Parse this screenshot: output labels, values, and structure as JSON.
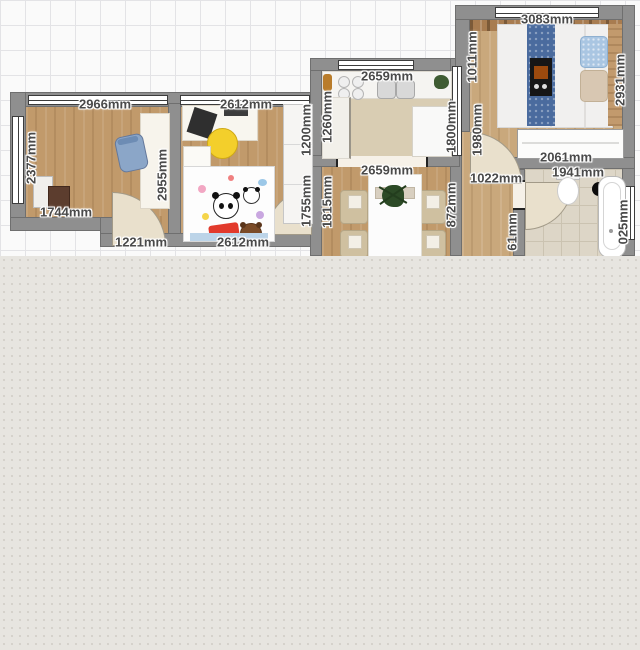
{
  "plan": {
    "unit": "mm",
    "labels": [
      {
        "text": "2966mm",
        "orientation": "horizontal",
        "room": "office",
        "edge": "top"
      },
      {
        "text": "2612mm",
        "orientation": "horizontal",
        "room": "kids-room",
        "edge": "top"
      },
      {
        "text": "2659mm",
        "orientation": "horizontal",
        "room": "kitchen",
        "edge": "top"
      },
      {
        "text": "3083mm",
        "orientation": "horizontal",
        "room": "bedroom",
        "edge": "top"
      },
      {
        "text": "2659mm",
        "orientation": "horizontal",
        "room": "dining-room",
        "edge": "top"
      },
      {
        "text": "1744mm",
        "orientation": "horizontal",
        "room": "office",
        "edge": "bottom"
      },
      {
        "text": "1221mm",
        "orientation": "horizontal",
        "room": "hallway",
        "edge": "bottom"
      },
      {
        "text": "2612mm",
        "orientation": "horizontal",
        "room": "kids-room",
        "edge": "bottom"
      },
      {
        "text": "1022mm",
        "orientation": "horizontal",
        "room": "hallway",
        "edge": "bathroom-door"
      },
      {
        "text": "2061mm",
        "orientation": "horizontal",
        "room": "bedroom",
        "edge": "wardrobe"
      },
      {
        "text": "1941mm",
        "orientation": "horizontal",
        "room": "bathroom",
        "edge": "top"
      },
      {
        "text": "2377mm",
        "orientation": "vertical",
        "room": "office",
        "edge": "left"
      },
      {
        "text": "2955mm",
        "orientation": "vertical",
        "room": "office",
        "edge": "right"
      },
      {
        "text": "1200mm",
        "orientation": "vertical",
        "room": "kids-room",
        "edge": "right-upper"
      },
      {
        "text": "1755mm",
        "orientation": "vertical",
        "room": "kids-room",
        "edge": "right-lower"
      },
      {
        "text": "1260mm",
        "orientation": "vertical",
        "room": "kitchen",
        "edge": "left"
      },
      {
        "text": "1815mm",
        "orientation": "vertical",
        "room": "dining-room",
        "edge": "left"
      },
      {
        "text": "1800mm",
        "orientation": "vertical",
        "room": "kitchen",
        "edge": "right"
      },
      {
        "text": "872mm",
        "orientation": "vertical",
        "room": "dining-room",
        "edge": "right"
      },
      {
        "text": "1011mm",
        "orientation": "vertical",
        "room": "bedroom",
        "edge": "left-upper"
      },
      {
        "text": "1980mm",
        "orientation": "vertical",
        "room": "bedroom",
        "edge": "left-lower"
      },
      {
        "text": "2931mm",
        "orientation": "vertical",
        "room": "bedroom",
        "edge": "right"
      },
      {
        "text": "61mm",
        "orientation": "vertical",
        "room": "bathroom",
        "edge": "left-truncated"
      },
      {
        "text": "025mm",
        "orientation": "vertical",
        "room": "bathroom",
        "edge": "right-truncated"
      }
    ],
    "rooms": [
      "office",
      "kids-room",
      "kitchen",
      "dining-room",
      "bedroom",
      "bathroom",
      "hallway"
    ],
    "furniture": {
      "office": [
        "desk",
        "office-chair",
        "cabinet",
        "storage-box"
      ],
      "kids-room": [
        "desk",
        "laptop",
        "printer",
        "kids-chair",
        "nightstand",
        "kids-bed",
        "panda-rug",
        "red-pillow",
        "teddy-bear",
        "wardrobe"
      ],
      "kitchen": [
        "countertop",
        "stove-burners",
        "double-sink",
        "plant",
        "side-counter",
        "rug",
        "island-table"
      ],
      "dining-room": [
        "dining-table",
        "centerpiece-plant",
        "chairs"
      ],
      "bedroom": [
        "shelf",
        "double-bed",
        "bed-runner",
        "tv",
        "pillows",
        "headboard",
        "wardrobe"
      ],
      "bathroom": [
        "toilet",
        "bathtub",
        "floor-fixture"
      ]
    }
  },
  "palette": {
    "wall": "#8f8f8f",
    "wood_floor": "#c19a6b",
    "grid_line": "#e3e3e6",
    "canvas_background": "#e7e5e0",
    "door_arc": "#e9e0cc",
    "office_chair_blue": "#8ba6c8",
    "kids_chair_yellow": "#f3cf2b",
    "bed_runner_blue": "#4a6b9e",
    "red_pillow": "#e23a2c",
    "rug_beige": "#d9cdb3"
  }
}
